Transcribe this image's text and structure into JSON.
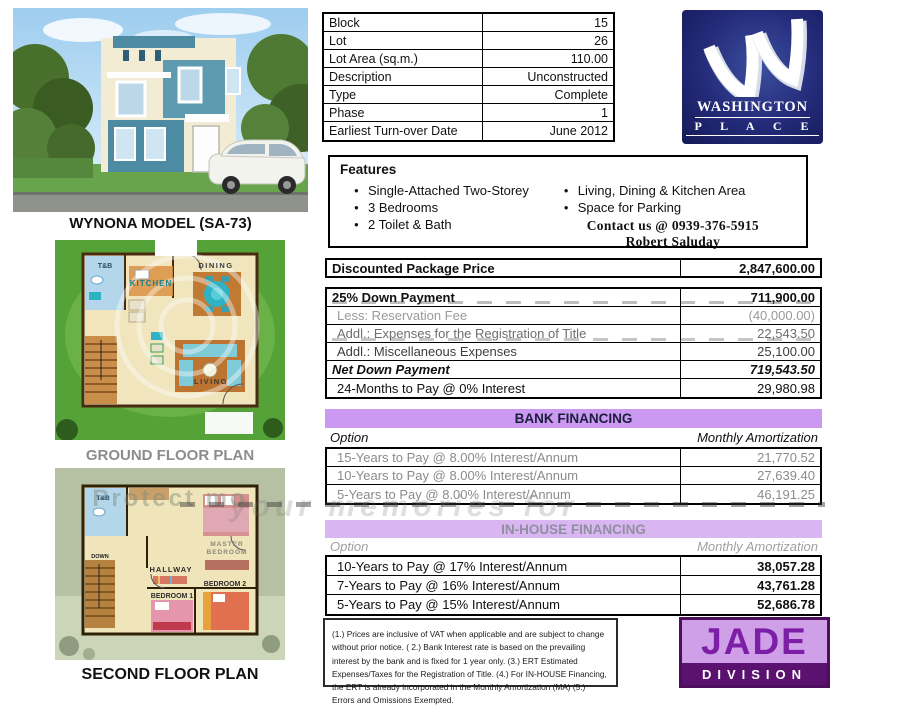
{
  "labels": {
    "model": "WYNONA MODEL (SA-73)",
    "ground_plan": "GROUND FLOOR PLAN",
    "second_plan": "SECOND FLOOR PLAN"
  },
  "info_table": {
    "rows": [
      {
        "label": "Block",
        "value": "15"
      },
      {
        "label": "Lot",
        "value": "26"
      },
      {
        "label": "Lot Area (sq.m.)",
        "value": "110.00"
      },
      {
        "label": "Description",
        "value": "Unconstructed"
      },
      {
        "label": "Type",
        "value": "Complete"
      },
      {
        "label": "Phase",
        "value": "1"
      },
      {
        "label": "Earliest Turn-over Date",
        "value": "June 2012"
      }
    ]
  },
  "features": {
    "title": "Features",
    "left": [
      "Single-Attached Two-Storey",
      "3 Bedrooms",
      "2 Toilet & Bath"
    ],
    "right": [
      "Living, Dining & Kitchen Area",
      "Space for Parking"
    ],
    "contact_line1": "Contact us @ 0939-376-5915",
    "contact_line2": "Robert Saluday"
  },
  "pricing": {
    "package": {
      "label": "Discounted Package Price",
      "value": "2,847,600.00"
    },
    "rows": [
      {
        "label": "25% Down Payment",
        "value": "711,900.00"
      },
      {
        "label": "Less: Reservation Fee",
        "value": "(40,000.00)"
      },
      {
        "label": "Addl.: Expenses for the Registration of Title",
        "value": "22,543.50"
      },
      {
        "label": "Addl.: Miscellaneous Expenses",
        "value": "25,100.00"
      },
      {
        "label": "Net Down Payment",
        "value": "719,543.50"
      },
      {
        "label": "24-Months to Pay @ 0% Interest",
        "value": "29,980.98"
      }
    ]
  },
  "bank_financing": {
    "header": "BANK FINANCING",
    "option_label": "Option",
    "amount_label": "Monthly Amortization",
    "rows": [
      {
        "label": "15-Years to Pay @ 8.00% Interest/Annum",
        "value": "21,770.52"
      },
      {
        "label": "10-Years to Pay @ 8.00% Interest/Annum",
        "value": "27,639.40"
      },
      {
        "label": "5-Years to Pay @ 8.00% Interest/Annum",
        "value": "46,191.25"
      }
    ]
  },
  "inhouse_financing": {
    "header": "IN-HOUSE FINANCING",
    "option_label": "Option",
    "amount_label": "Monthly Amortization",
    "rows": [
      {
        "label": "10-Years to Pay @ 17% Interest/Annum",
        "value": "38,057.28"
      },
      {
        "label": "7-Years to Pay @ 16% Interest/Annum",
        "value": "43,761.28"
      },
      {
        "label": "5-Years to Pay @ 15% Interest/Annum",
        "value": "52,686.78"
      }
    ]
  },
  "notes": "(1.)  Prices are inclusive of VAT when applicable and are subject to change without prior notice.  ( 2.) Bank Interest rate is based on the prevailing interest by the bank and is fixed for 1 year only.   (3.)  ERT Estimated Expenses/Taxes for the Registration of Title.  (4.) For IN-HOUSE Financing, the ERT is already incorporated in the Monthly Amortization (MA) (5.) Errors and Omissions Exempted.",
  "logos": {
    "washington_line1": "WASHINGTON",
    "washington_line2": "P L A C E",
    "jade": "JADE",
    "jade_sub": "DIVISION"
  },
  "floor_plans": {
    "ground": {
      "tb": "T&B",
      "kitchen": "KITCHEN",
      "dining": "DINING",
      "living": "LIVING"
    },
    "second": {
      "tb": "T&B",
      "master1": "MASTER",
      "master2": "BEDROOM",
      "hallway": "HALLWAY",
      "bed1": "BEDROOM 1",
      "bed2": "BEDROOM 2",
      "down": "DOWN"
    }
  },
  "watermark": {
    "band_text": "your memories for"
  },
  "colors": {
    "accent_purple": "#cb99f2",
    "navy_logo": "#1b1f66",
    "jade_purple": "#5a1170",
    "jade_lavender": "#cf9fe8"
  }
}
